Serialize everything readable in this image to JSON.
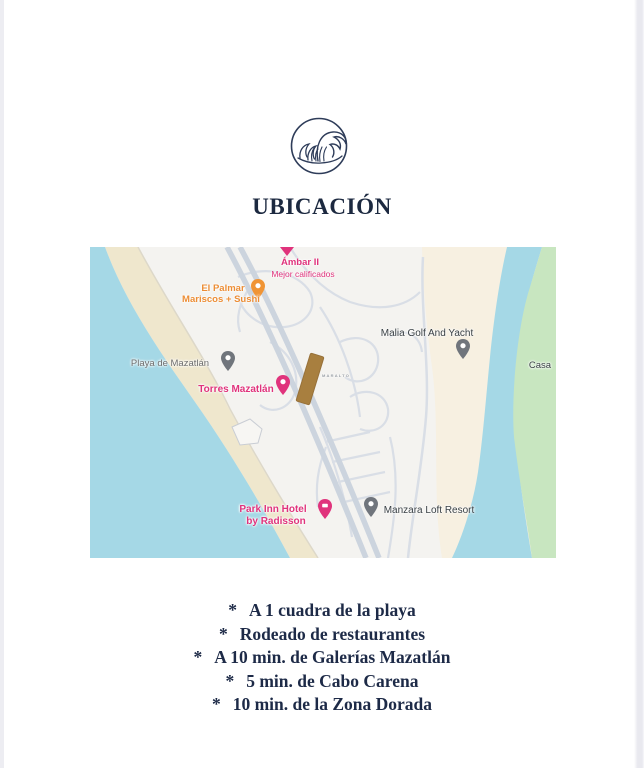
{
  "title": "UBICACIÓN",
  "logo": {
    "name": "wave-logo"
  },
  "map": {
    "labels": {
      "ambar": {
        "line1": "Ámbar II",
        "line2": "Mejor calificados"
      },
      "palmar": {
        "line1": "El Palmar",
        "line2": "Mariscos + Sushi"
      },
      "playa": {
        "text": "Playa de Mazatlán"
      },
      "torres": {
        "text": "Torres Mazatlán"
      },
      "malia": {
        "text": "Malia Golf And Yacht"
      },
      "casa": {
        "text": "Casa"
      },
      "property": {
        "text": "MARALTO"
      },
      "parkinn": {
        "line1": "Park Inn Hotel",
        "line2": "by Radisson"
      },
      "manzara": {
        "text": "Manzara Loft Resort"
      }
    },
    "colors": {
      "water": "#a5d8e6",
      "sand": "#efe7cd",
      "cream_land": "#f7f0e1",
      "green_land": "#c8e6c0",
      "urban": "#f4f3f0",
      "road": "#ccd4de",
      "label_pink": "#e0337c",
      "label_orange": "#ec8d35",
      "property_brown": "#a87f3f"
    }
  },
  "bullets": {
    "marker": "*",
    "items": [
      "A  1 cuadra de la playa",
      "Rodeado de restaurantes",
      "A 10 min. de Galerías Mazatlán",
      "5 min. de Cabo Carena",
      "10 min. de la Zona Dorada"
    ]
  },
  "theme": {
    "accent_navy": "#1c2940"
  }
}
